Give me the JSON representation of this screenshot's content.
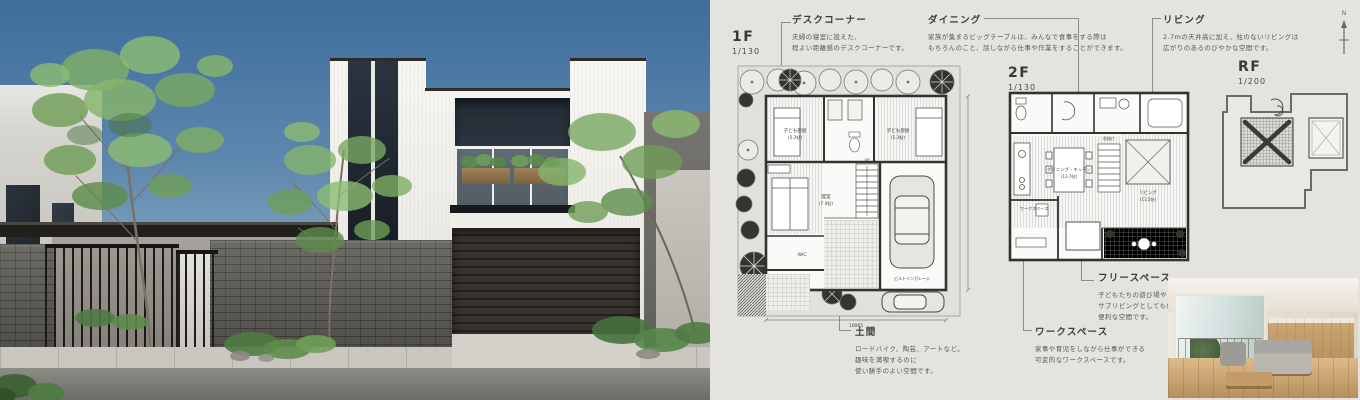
{
  "colors": {
    "panel_bg": "#e5e3df",
    "plan_line": "#3a3934",
    "annotation_text": "#5a5852"
  },
  "annotations": {
    "desk": {
      "title": "デスクコーナー",
      "lines": [
        "夫婦の寝室に設えた、",
        "程よい距離感のデスクコーナーです。"
      ]
    },
    "dining": {
      "title": "ダイニング",
      "lines": [
        "家族が集まるビッグテーブルは、みんなで食事をする際は",
        "もちろんのこと、話しながら仕事や作業をすることができます。"
      ]
    },
    "living": {
      "title": "リビング",
      "lines": [
        "2.7mの天井高に加え、柱のないリビングは",
        "広がりのあるのびやかな空間です。"
      ]
    },
    "free_space": {
      "title": "フリースペース",
      "lines": [
        "子どもたちの遊び場や",
        "サブリビングとしても使える",
        "便利な空間です。"
      ]
    },
    "work_space": {
      "title": "ワークスペース",
      "lines": [
        "家事や育児をしながら仕事ができる",
        "可変的なワークスペースです。"
      ]
    },
    "doma": {
      "title": "土間",
      "lines": [
        "ロードバイク、陶芸、アートなど。",
        "趣味を満喫するのに",
        "使い勝手のよい空間です。"
      ]
    }
  },
  "plans": {
    "north_label": "N",
    "f1": {
      "title": "1F",
      "scale": "1/130",
      "labels": {
        "child_a": "子ども部屋",
        "child_a_size": "(5.2帖)",
        "child_b": "子ども部屋",
        "child_b_size": "(5.2帖)",
        "bedroom": "寝室",
        "bedroom_size": "(7.0帖)",
        "wic": "WIC",
        "stairs": "UP",
        "garage": "ビルトインガレージ",
        "dim": "10065"
      }
    },
    "f2": {
      "title": "2F",
      "scale": "1/130",
      "labels": {
        "dk": "ダイニング・キッチン",
        "dk_size": "(13.7帖)",
        "living": "リビング",
        "living_size": "(11.5帖)",
        "work": "ワークスペース",
        "void": "吹抜け"
      }
    },
    "rf": {
      "title": "RF",
      "scale": "1/200"
    }
  }
}
